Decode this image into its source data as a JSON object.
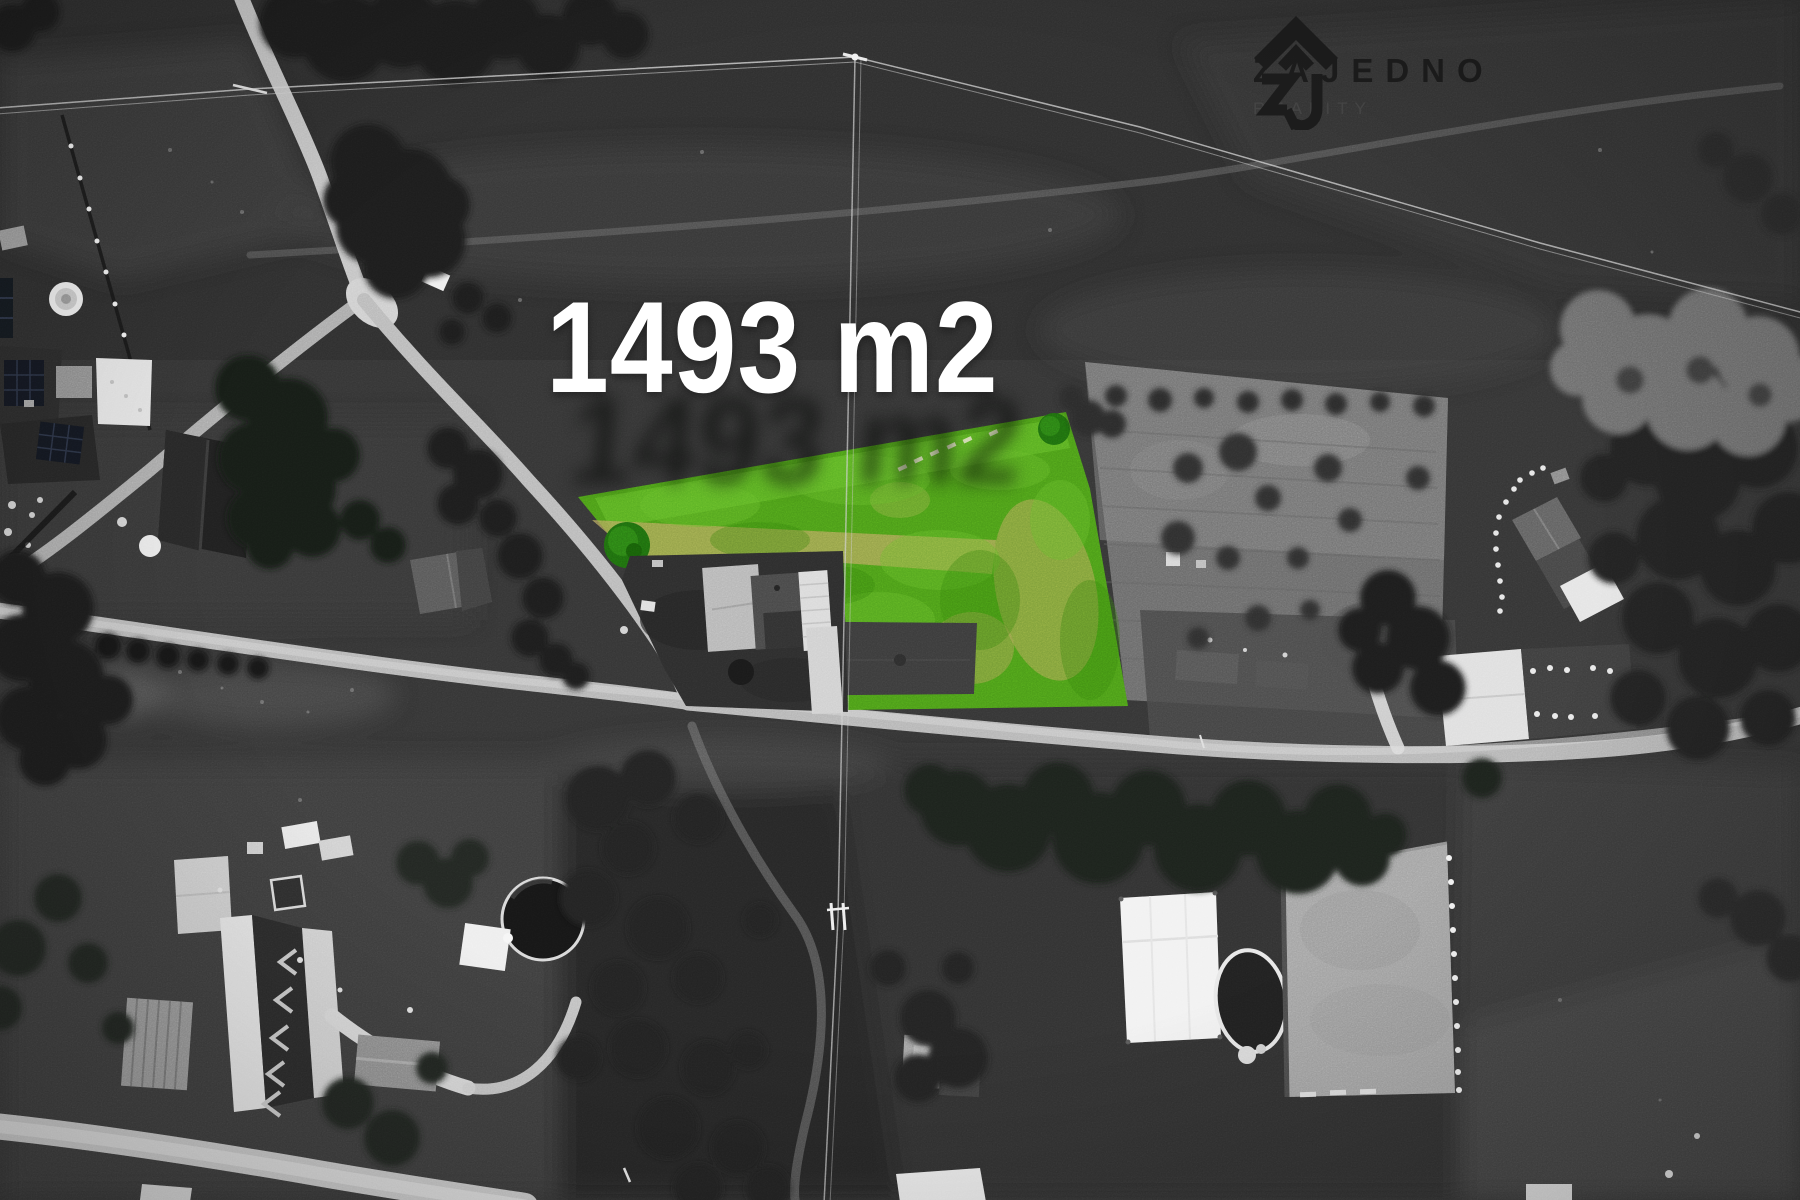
{
  "plot_label": {
    "text": "1493 m2"
  },
  "brand": {
    "name": "ZAJEDNO",
    "tagline": "REALITY"
  },
  "colors": {
    "plot_highlight": "#4a9a18",
    "plot_highlight_bright": "#5db325",
    "dry_grass": "#b3a45c",
    "label_text": "#ffffff",
    "brand_dark": "#1c1c1c",
    "brand_tagline": "#454545"
  }
}
